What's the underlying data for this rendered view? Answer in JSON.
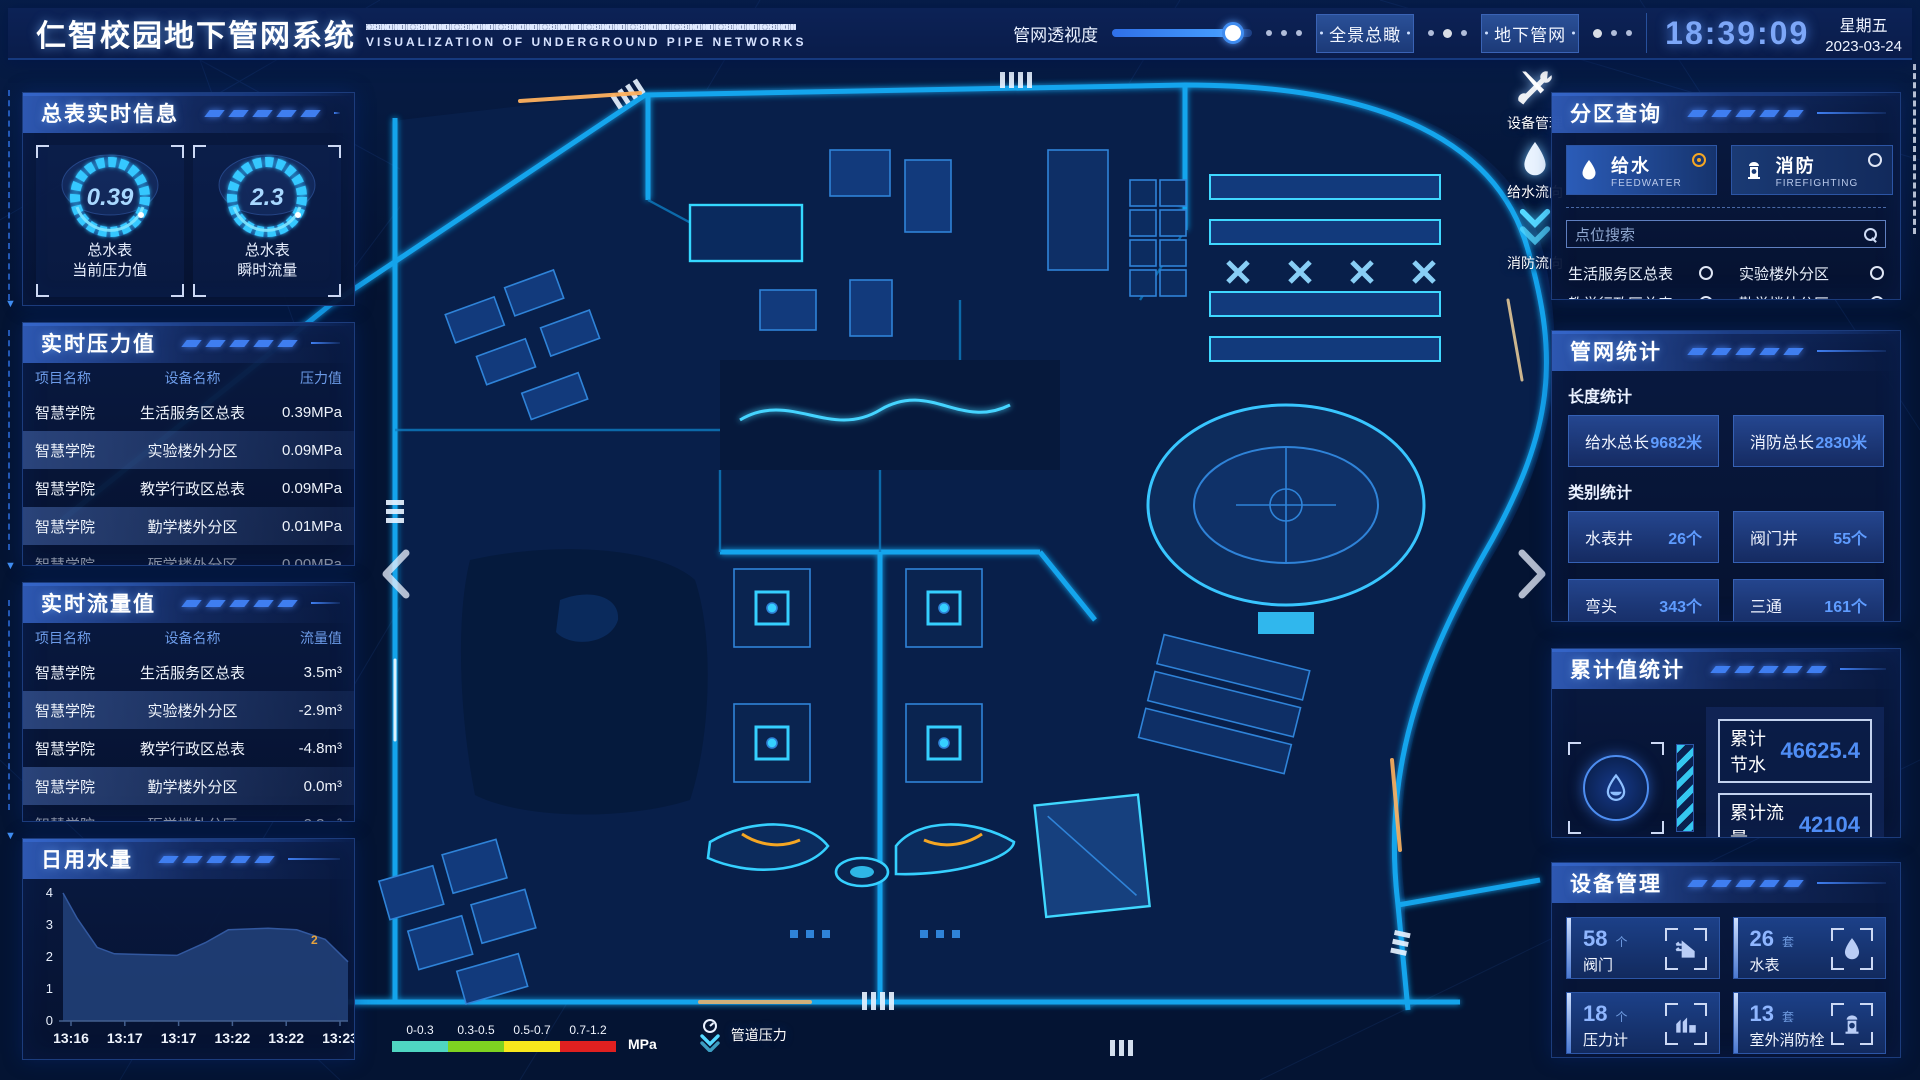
{
  "header": {
    "title": "仁智校园地下管网系统",
    "subtitle": "VISUALIZATION OF UNDERGROUND PIPE NETWORKS",
    "opacity_label": "管网透视度",
    "btn_overview": "全景总瞰",
    "btn_underground": "地下管网",
    "time": "18:39:09",
    "weekday": "星期五",
    "date": "2023-03-24"
  },
  "left": {
    "meter_panel": {
      "title": "总表实时信息",
      "gauges": [
        {
          "value": "0.39",
          "line1": "总水表",
          "line2": "当前压力值"
        },
        {
          "value": "2.3",
          "line1": "总水表",
          "line2": "瞬时流量"
        }
      ]
    },
    "pressure": {
      "title": "实时压力值",
      "headers": [
        "项目名称",
        "设备名称",
        "压力值"
      ],
      "rows": [
        {
          "project": "智慧学院",
          "device": "生活服务区总表",
          "value": "0.39MPa"
        },
        {
          "project": "智慧学院",
          "device": "实验楼外分区",
          "value": "0.09MPa"
        },
        {
          "project": "智慧学院",
          "device": "教学行政区总表",
          "value": "0.09MPa"
        },
        {
          "project": "智慧学院",
          "device": "勤学楼外分区",
          "value": "0.01MPa"
        },
        {
          "project": "智慧学院",
          "device": "砺学楼外分区",
          "value": "0.00MPa"
        }
      ]
    },
    "flow": {
      "title": "实时流量值",
      "headers": [
        "项目名称",
        "设备名称",
        "流量值"
      ],
      "rows": [
        {
          "project": "智慧学院",
          "device": "生活服务区总表",
          "value": "3.5m³"
        },
        {
          "project": "智慧学院",
          "device": "实验楼外分区",
          "value": "-2.9m³"
        },
        {
          "project": "智慧学院",
          "device": "教学行政区总表",
          "value": "-4.8m³"
        },
        {
          "project": "智慧学院",
          "device": "勤学楼外分区",
          "value": "0.0m³"
        },
        {
          "project": "智慧学院",
          "device": "砺学楼外分区",
          "value": "2.3m³"
        }
      ]
    },
    "daily": {
      "title": "日用水量"
    }
  },
  "right": {
    "query": {
      "title": "分区查询",
      "tabs": [
        {
          "label": "给水",
          "sub": "FEEDWATER",
          "selected": true
        },
        {
          "label": "消防",
          "sub": "FIREFIGHTING",
          "selected": false
        }
      ],
      "search_placeholder": "点位搜索",
      "points": [
        "生活服务区总表",
        "实验楼外分区",
        "教学行政区总表",
        "勤学楼外分区",
        "砺学楼外分区",
        "宿舍区泵房"
      ]
    },
    "stats": {
      "title": "管网统计",
      "length_label": "长度统计",
      "length_items": [
        {
          "label": "给水总长",
          "value": "9682米"
        },
        {
          "label": "消防总长",
          "value": "2830米"
        }
      ],
      "category_label": "类别统计",
      "category_items": [
        {
          "label": "水表井",
          "value": "26个"
        },
        {
          "label": "阀门井",
          "value": "55个"
        },
        {
          "label": "弯头",
          "value": "343个"
        },
        {
          "label": "三通",
          "value": "161个"
        }
      ]
    },
    "accum": {
      "title": "累计值统计",
      "items": [
        {
          "label": "累计节水",
          "value": "46625.4"
        },
        {
          "label": "累计流量",
          "value": "42104"
        }
      ]
    },
    "devices": {
      "title": "设备管理",
      "cards": [
        {
          "count": "58",
          "unit": "个",
          "label": "阀门"
        },
        {
          "count": "26",
          "unit": "套",
          "label": "水表"
        },
        {
          "count": "18",
          "unit": "个",
          "label": "压力计"
        },
        {
          "count": "13",
          "unit": "套",
          "label": "室外消防栓"
        }
      ]
    }
  },
  "map": {
    "tools_label": "设备管理",
    "feed_label": "给水流向",
    "fire_label": "消防流向",
    "legend": {
      "ranges": [
        "0-0.3",
        "0.3-0.5",
        "0.5-0.7",
        "0.7-1.2"
      ],
      "colors": [
        "#4fd6c2",
        "#7ed321",
        "#f8e71c",
        "#e02020"
      ],
      "unit": "MPa",
      "label": "管道压力"
    },
    "accent_blue": "#35c8ff",
    "accent_orange": "#f5a623"
  },
  "chart_data": {
    "type": "area",
    "title": "日用水量",
    "x_ticks": [
      "13:16",
      "13:17",
      "13:17",
      "13:22",
      "13:22",
      "13:23"
    ],
    "yticks": [
      0,
      1,
      2,
      3,
      4
    ],
    "ylim": [
      0,
      4
    ],
    "series": [
      {
        "name": "日用水量",
        "points": [
          {
            "x": 0.0,
            "y": 4.0
          },
          {
            "x": 0.05,
            "y": 3.2
          },
          {
            "x": 0.12,
            "y": 2.3
          },
          {
            "x": 0.18,
            "y": 2.1
          },
          {
            "x": 0.4,
            "y": 2.05
          },
          {
            "x": 0.5,
            "y": 2.45
          },
          {
            "x": 0.58,
            "y": 2.85
          },
          {
            "x": 0.72,
            "y": 2.9
          },
          {
            "x": 0.82,
            "y": 2.85
          },
          {
            "x": 0.92,
            "y": 2.55
          },
          {
            "x": 1.0,
            "y": 1.85
          }
        ]
      }
    ],
    "annotation": {
      "text": "2",
      "x": 0.87,
      "y": 2.4,
      "color": "#e8a33d"
    },
    "grid": false,
    "legend_position": "none"
  }
}
